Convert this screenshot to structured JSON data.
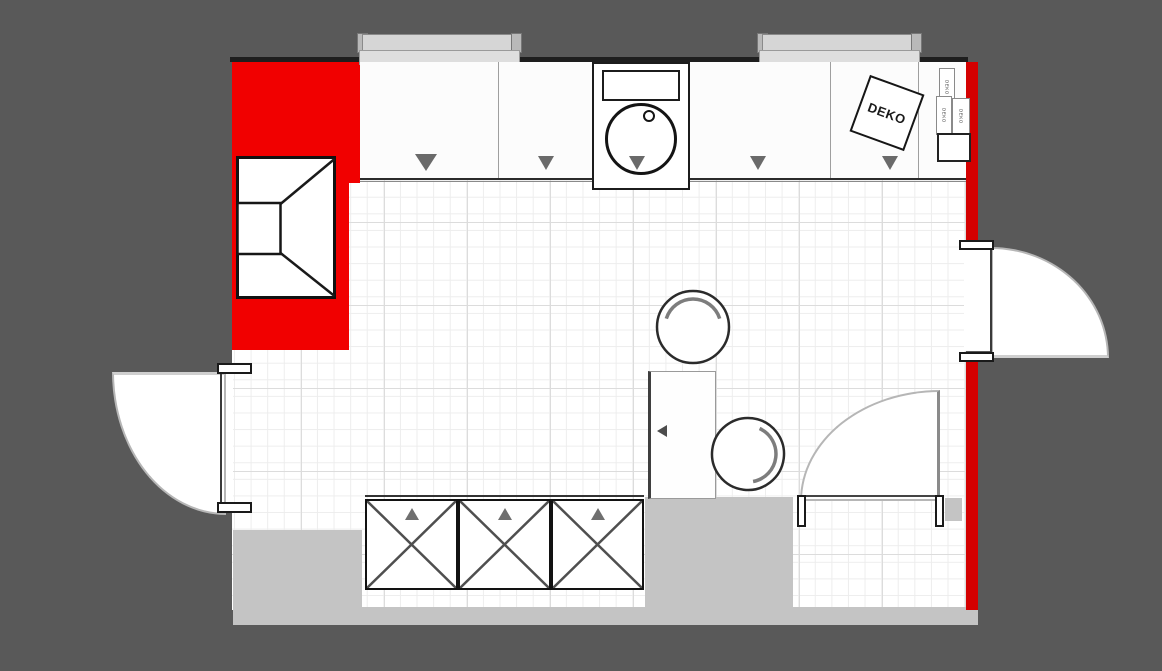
{
  "canvas": {
    "background": "#595959",
    "floor_color": "#ffffff"
  },
  "colors": {
    "wall_red_left": "#f10000",
    "wall_red_right": "#d40000",
    "wall_gray_mass": "#c4c4c4",
    "wall_top_dark": "#1e1e1e",
    "grid_minor": "#ededed",
    "grid_major": "#dcdcdc",
    "marker_gray": "#6a6a6a",
    "window_gray": "#d6d6d6"
  },
  "labels": {
    "deko_main": "DEKO",
    "deko_strips": [
      "DEKO",
      "DEKO",
      "DEKO"
    ]
  },
  "symbols": {
    "upper_cabinet_door_markers": 5,
    "base_cabinet_units_with_cross": 3,
    "base_cabinet_door_markers": 3,
    "doors": 3,
    "windows": 2,
    "chairs": 2,
    "sink": 1,
    "corner_cabinet": 1,
    "tall_unit": 1
  }
}
